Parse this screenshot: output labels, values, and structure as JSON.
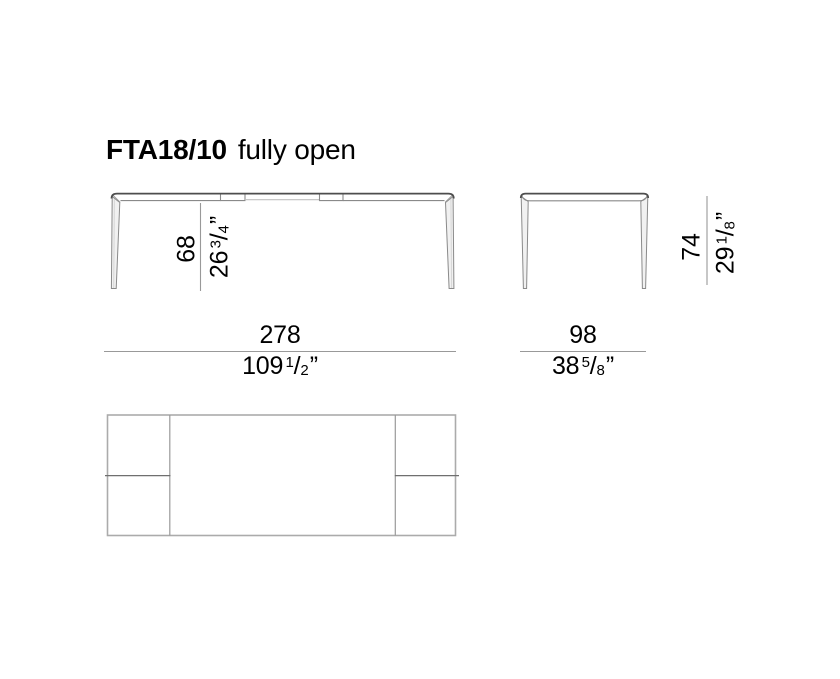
{
  "title": {
    "model": "FTA18/10",
    "state": "fully open"
  },
  "dimensions": {
    "height_front": {
      "metric": "68",
      "imperial": {
        "whole": "26",
        "numerator": "3",
        "slash": "/",
        "denominator": "4",
        "unit": "”"
      }
    },
    "height_side": {
      "metric": "74",
      "imperial": {
        "whole": "29",
        "numerator": "1",
        "slash": "/",
        "denominator": "8",
        "unit": "”"
      }
    },
    "width_front": {
      "metric": "278",
      "imperial": {
        "whole": "109",
        "numerator": "1",
        "slash": "/",
        "denominator": "2",
        "unit": "”"
      }
    },
    "depth_side": {
      "metric": "98",
      "imperial": {
        "whole": "38",
        "numerator": "5",
        "slash": "/",
        "denominator": "8",
        "unit": "”"
      }
    }
  },
  "colors": {
    "background": "#ffffff",
    "text": "#000000",
    "tabletop_edge": "#4d4d4d",
    "drawing_line": "#8a8a8a",
    "leaf_line_light": "#c0c0c0",
    "dimension_line": "#999999",
    "plan_outline": "#ababab",
    "plan_divider": "#9a9a9a",
    "plan_midline": "#6f6f6f"
  }
}
